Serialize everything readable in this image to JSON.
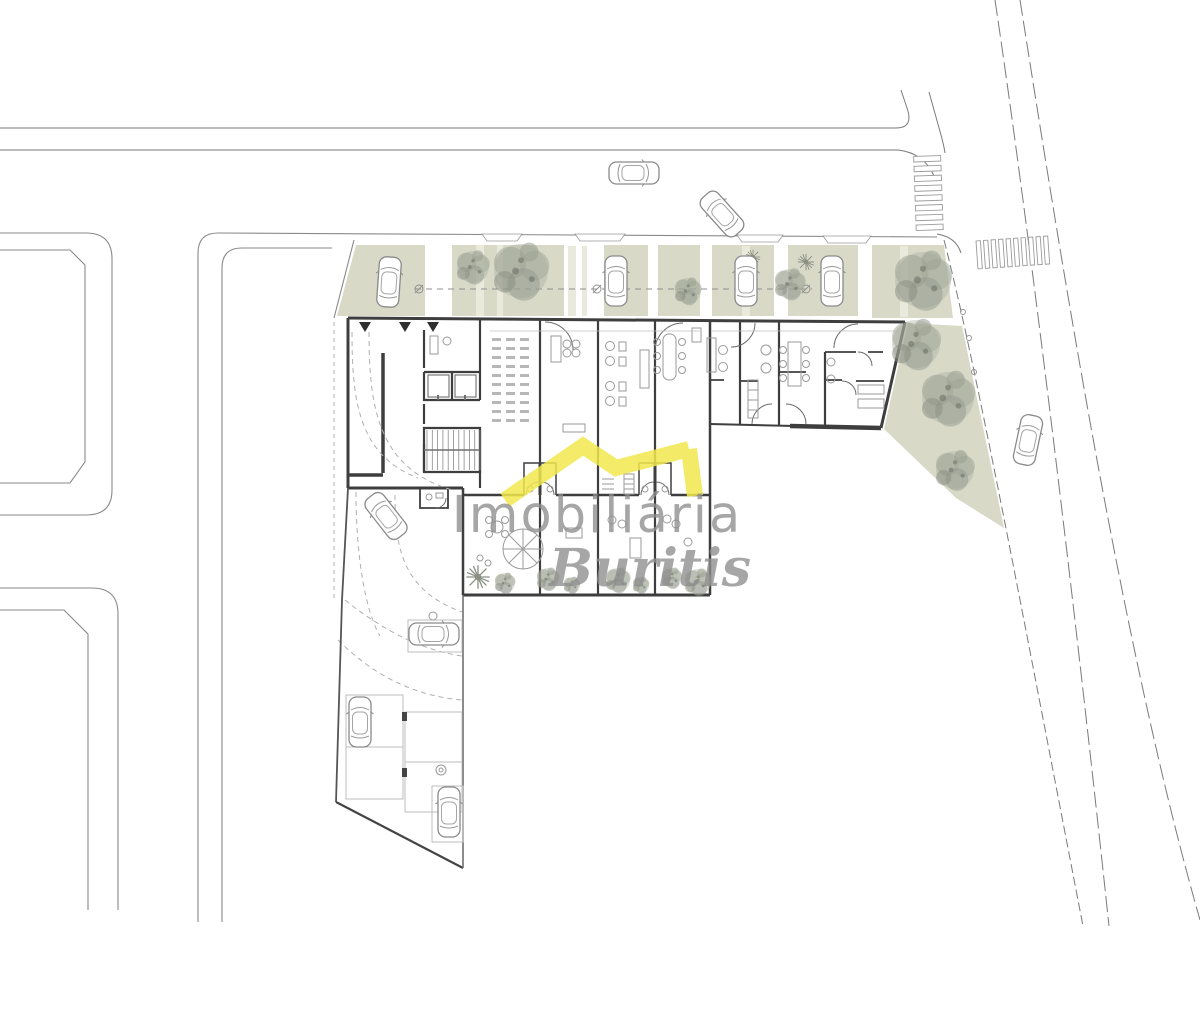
{
  "watermark": {
    "line1": "Imobiliária",
    "line2": "Buritis"
  },
  "palette": {
    "paper": "#ffffff",
    "wall": "#3e3e3e",
    "line_light": "#9a9a9a",
    "road_line": "#7a7a7a",
    "olive": "#d8d9c7",
    "olive_pale": "#e9eadb",
    "yellow": "#f2e84d",
    "watermark_gray": "#8e8e8e",
    "tree_gray": "#9aa092",
    "car_line": "#8a8a8a"
  },
  "plan": {
    "trees": [
      {
        "x": 473,
        "y": 267,
        "s": 1.6,
        "t": 1
      },
      {
        "x": 521,
        "y": 271,
        "s": 2.7,
        "t": 1
      },
      {
        "x": 688,
        "y": 291,
        "s": 1.3,
        "t": 1
      },
      {
        "x": 806,
        "y": 262,
        "s": 0.9,
        "t": 2
      },
      {
        "x": 790,
        "y": 284,
        "s": 1.5,
        "t": 1
      },
      {
        "x": 753,
        "y": 257,
        "s": 0.8,
        "t": 2
      },
      {
        "x": 923,
        "y": 280,
        "s": 2.8,
        "t": 1
      },
      {
        "x": 916,
        "y": 344,
        "s": 2.4,
        "t": 1
      },
      {
        "x": 948,
        "y": 398,
        "s": 2.6,
        "t": 1
      },
      {
        "x": 955,
        "y": 470,
        "s": 1.9,
        "t": 1
      },
      {
        "x": 478,
        "y": 577,
        "s": 1.3,
        "t": 2
      },
      {
        "x": 505,
        "y": 583,
        "s": 1.0,
        "t": 1
      },
      {
        "x": 548,
        "y": 579,
        "s": 1.1,
        "t": 1
      },
      {
        "x": 572,
        "y": 585,
        "s": 0.8,
        "t": 1
      },
      {
        "x": 618,
        "y": 580,
        "s": 1.2,
        "t": 1
      },
      {
        "x": 641,
        "y": 585,
        "s": 0.8,
        "t": 1
      },
      {
        "x": 672,
        "y": 578,
        "s": 1.0,
        "t": 1
      },
      {
        "x": 698,
        "y": 582,
        "s": 1.3,
        "t": 1
      }
    ],
    "cars": [
      {
        "x": 389,
        "y": 282,
        "r": 4
      },
      {
        "x": 616,
        "y": 281,
        "r": 0
      },
      {
        "x": 746,
        "y": 281,
        "r": 0
      },
      {
        "x": 832,
        "y": 281,
        "r": 0
      },
      {
        "x": 634,
        "y": 173,
        "r": 90
      },
      {
        "x": 722,
        "y": 214,
        "r": -42
      },
      {
        "x": 1028,
        "y": 440,
        "r": 12
      },
      {
        "x": 386,
        "y": 516,
        "r": -38
      },
      {
        "x": 434,
        "y": 634,
        "r": 90
      },
      {
        "x": 360,
        "y": 722,
        "r": 0
      },
      {
        "x": 449,
        "y": 812,
        "r": 0
      }
    ],
    "crosswalks": {
      "vertical_rungs": 8,
      "horizontal_bars": 10
    },
    "shelves": {
      "columns": [
        492,
        506,
        520
      ],
      "y0": 338,
      "count": 10,
      "step": 9,
      "w": 9,
      "h": 3
    },
    "stairs": {
      "x": 427,
      "y": 430,
      "h": 40,
      "treads": 11,
      "step": 5.3
    }
  }
}
